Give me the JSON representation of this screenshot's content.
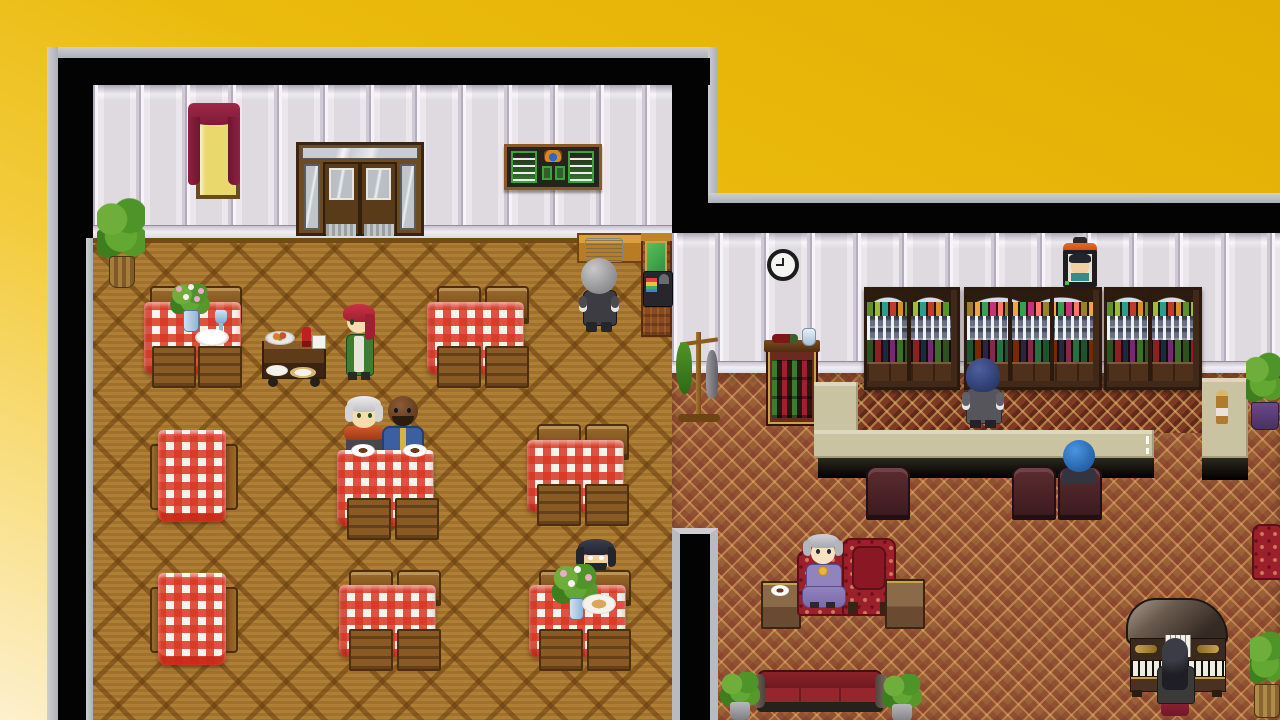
{
  "labels": {
    "stage": "Top-down tavern interior - restaurant and bar lounge",
    "restaurant_room": "Restaurant dining room with wooden parquet floor",
    "lounge_room": "Bar lounge with patterned carpet",
    "window": "Window with dark red curtains",
    "door": "Double wooden entrance door with glass panes",
    "menu_board": "Menu chalkboard with green lettering",
    "reception_counter": "Reception counter",
    "ledger": "Open ledger book",
    "counter_sign": "Green counter sign",
    "cash_register": "Cash register",
    "clerk": "Gray-haired clerk in dark suit at the counter",
    "waitress": "Red-haired waitress in green uniform with white apron",
    "food_cart": "Wooden serving cart with dishes and wine bottle",
    "dining_table": "Table with red-white checkered tablecloth",
    "table_flowers": "Vase of pink flowers",
    "table_goblet": "Blue goblet",
    "table_plate": "White plate",
    "coffee_cup": "Cup of coffee on saucer",
    "old_man": "White-haired man with red scarf seated at table",
    "bald_man": "Dark-skinned bald man in blue robe seated at table",
    "bearded_man": "Black-haired bearded man in blue cloak dining alone",
    "potted_plant": "Potted green plant",
    "wall_clock": "Round wall clock showing 9:00",
    "portrait": "Framed portrait with orange top",
    "coat_rack": "Coat rack with green coat and umbrella",
    "wine_cabinet": "Wine cabinet with bottle and glass on top",
    "bar_shelf": "Bar shelf cabinet with bottles and rows of glasses",
    "bar_counter": "U-shaped beige bar counter",
    "counter_bottle": "Amber bottle on counter",
    "bartender": "Navy-haired bartender in gray suit behind the counter",
    "bar_patron": "Blue-haired patron seated at the bar",
    "bar_chair": "Dark carved bar chair",
    "old_lady": "Elderly lady in purple dress seated on armchair",
    "armchair": "Red tufted armchair",
    "side_table": "Small wooden side table",
    "sofa": "Dark red sofa",
    "grand_piano": "Grand piano",
    "pianist": "Long-haired pianist at the piano",
    "clock_time": "9:00"
  },
  "palette": {
    "background_gold_top": "#e2af03",
    "background_gold_bottom": "#fdf0cd",
    "border_gray": "#b9bbc0",
    "wall_black": "#030303",
    "wall_panel": "#eae6ec",
    "wood_floor": "#a9772e",
    "lounge_carpet": "#9a6038",
    "bar_strip_carpet": "#7c3a24",
    "tablecloth_red": "#d83724",
    "counter_beige": "#c9c3a2",
    "armchair_red": "#9c1f2c",
    "plant_green": "#63a832"
  }
}
